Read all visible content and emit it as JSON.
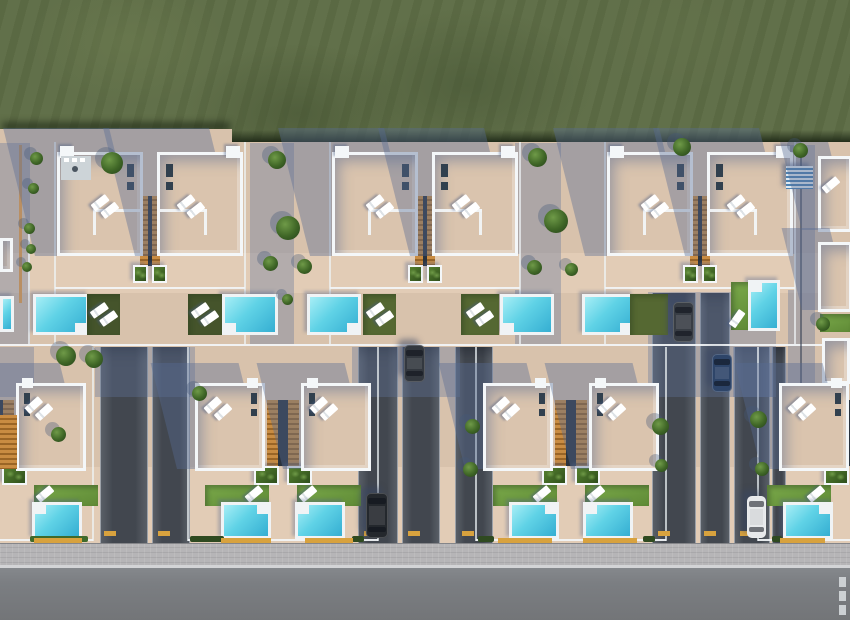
{
  "meta": {
    "description": "Aerial top-down 3D architectural render of a villa development: green field above, two rows of white semi-detached villas with beige roof terraces, sun loungers, orange stair cores, green planters, lawns and turquoise pools, dark private driveways with parked cars, a cobbled sidewalk and an asphalt road along the bottom.",
    "width": 850,
    "height": 620
  },
  "palette": {
    "grass": "#5e6d46",
    "grass_light": "#6d7c52",
    "grass_dark": "#4a593a",
    "grass_shadow": "#222e1c",
    "ground": "#d8c2ac",
    "ground_lit": "#e2ccb6",
    "wall": "#f4f7f9",
    "roof": "#dac4ae",
    "roof_inner_shadow": "rgba(85,105,145,0.5)",
    "cast_shadow": "rgba(88,108,148,0.40)",
    "ambient_shadow": "rgba(96,117,156,0.36)",
    "drive_mid": "#42474f",
    "drive_edge": "#5d636b",
    "deck": "#f0f3f5",
    "water_light": "#a7eef6",
    "water_mid": "#5fd2e6",
    "water_deep": "#35aed2",
    "lawn_bright_1": "#7aa94a",
    "lawn_bright_2": "#5f8a36",
    "lawn_mid": "#556832",
    "lawn_dark": "#45542b",
    "stair": "#c98c42",
    "stair_dark": "#9a6526",
    "stair_slit": "#2b333d",
    "planter_1": "#55802f",
    "planter_2": "#2f4f1c",
    "tree_light": "#6f9a48",
    "tree_mid": "#3f6626",
    "tree_dark": "#24401a",
    "sidewalk": "#b6b5b7",
    "curb": "#d3d4d6",
    "road": "#7b7e82",
    "road_dash": "#ccd0d3",
    "curb_yellow": "#d8a23e",
    "slot_dark": "#31404e",
    "pergola_blue": "#4d82b2",
    "pergola_white": "#dfe9f1",
    "kitchen": "#cdd4d8",
    "kitchen_dark": "#4a5560",
    "fence_tan": "#b98f63",
    "car_glass": "rgba(12,17,26,0.55)"
  },
  "bands": {
    "grass_h": 142,
    "step_w": 232,
    "lit_bands": [
      [
        0,
        253,
        850,
        40
      ],
      [
        0,
        467,
        850,
        76
      ]
    ],
    "fence_y": 344,
    "sidewalk_y": 543,
    "road_y": 568
  },
  "row1_pairs": [
    {
      "cx": 150,
      "kitchen": true,
      "pools": [
        {
          "x": 33,
          "y": 294,
          "w": 56,
          "h": 41,
          "step": "br"
        },
        {
          "x": 222,
          "y": 294,
          "w": 56,
          "h": 41,
          "step": "bl"
        }
      ],
      "lawns": [
        {
          "x": 87,
          "y": 294,
          "w": 33,
          "h": 41,
          "shade": "dark",
          "loungers": "pair",
          "lrot": -35
        },
        {
          "x": 188,
          "y": 294,
          "w": 34,
          "h": 41,
          "shade": "dark",
          "loungers": "pair",
          "lrot": -35
        }
      ]
    },
    {
      "cx": 425,
      "pools": [
        {
          "x": 307,
          "y": 294,
          "w": 54,
          "h": 41,
          "step": "br"
        },
        {
          "x": 500,
          "y": 294,
          "w": 54,
          "h": 41,
          "step": "bl"
        }
      ],
      "lawns": [
        {
          "x": 363,
          "y": 294,
          "w": 33,
          "h": 41,
          "shade": "mid",
          "loungers": "pair",
          "lrot": -35
        },
        {
          "x": 461,
          "y": 294,
          "w": 38,
          "h": 41,
          "shade": "mid",
          "loungers": "pair",
          "lrot": -35
        }
      ]
    },
    {
      "cx": 700,
      "pools": [
        {
          "x": 582,
          "y": 294,
          "w": 52,
          "h": 41,
          "step": "br"
        },
        {
          "x": 748,
          "y": 280,
          "w": 32,
          "h": 51,
          "step": "tl"
        }
      ],
      "lawns": [
        {
          "x": 630,
          "y": 294,
          "w": 38,
          "h": 41,
          "shade": "mid"
        },
        {
          "x": 731,
          "y": 282,
          "w": 17,
          "h": 48,
          "shade": "bright",
          "loungers": "single",
          "lrot": -55,
          "lx": 733,
          "ly": 310
        }
      ]
    }
  ],
  "row2_pairs": [
    {
      "cx": -2,
      "sides": "right",
      "pool_shift": 22
    },
    {
      "cx": 283,
      "sides": "both"
    },
    {
      "cx": 571,
      "sides": "both"
    },
    {
      "cx": 853,
      "sides": "left",
      "pool_shift": -8,
      "house_shift": 14
    }
  ],
  "driveways": [
    {
      "x": 100,
      "w": 48
    },
    {
      "x": 152,
      "w": 38
    },
    {
      "x": 358,
      "w": 40
    },
    {
      "x": 402,
      "w": 38
    },
    {
      "x": 455,
      "w": 38
    },
    {
      "x": 652,
      "w": 44,
      "y0": 293
    },
    {
      "x": 700,
      "w": 30,
      "y0": 293
    },
    {
      "x": 734,
      "w": 36
    },
    {
      "x": 772,
      "w": 14
    }
  ],
  "corridor_shadows": [
    [
      250,
      143,
      44,
      201
    ],
    [
      515,
      143,
      46,
      201
    ],
    [
      788,
      145,
      27,
      255
    ],
    [
      0,
      143,
      30,
      201
    ],
    [
      95,
      347,
      100,
      50
    ],
    [
      352,
      347,
      108,
      50
    ],
    [
      648,
      292,
      128,
      105
    ],
    [
      0,
      347,
      34,
      50
    ],
    [
      733,
      347,
      40,
      50
    ]
  ],
  "trees": [
    [
      112,
      163,
      22
    ],
    [
      36,
      158,
      13
    ],
    [
      33,
      188,
      11
    ],
    [
      29,
      228,
      11
    ],
    [
      31,
      249,
      10
    ],
    [
      27,
      267,
      10
    ],
    [
      277,
      160,
      18
    ],
    [
      288,
      228,
      24
    ],
    [
      270,
      263,
      15
    ],
    [
      304,
      266,
      15
    ],
    [
      537,
      157,
      19
    ],
    [
      556,
      221,
      24
    ],
    [
      534,
      267,
      15
    ],
    [
      571,
      269,
      13
    ],
    [
      682,
      147,
      18
    ],
    [
      800,
      150,
      15
    ],
    [
      823,
      324,
      14
    ],
    [
      66,
      356,
      20
    ],
    [
      94,
      359,
      18
    ],
    [
      58,
      434,
      15
    ],
    [
      199,
      393,
      15
    ],
    [
      472,
      426,
      15
    ],
    [
      470,
      469,
      15
    ],
    [
      660,
      426,
      17
    ],
    [
      661,
      465,
      13
    ],
    [
      758,
      419,
      17
    ],
    [
      762,
      469,
      14
    ],
    [
      287,
      299,
      11
    ]
  ],
  "cars": [
    {
      "x": 404,
      "y": 345,
      "w": 21,
      "h": 37,
      "color": "#33383f"
    },
    {
      "x": 673,
      "y": 302,
      "w": 21,
      "h": 40,
      "color": "#383d44"
    },
    {
      "x": 712,
      "y": 354,
      "w": 20,
      "h": 38,
      "color": "#2e4569"
    },
    {
      "x": 366,
      "y": 493,
      "w": 22,
      "h": 45,
      "color": "#24282d"
    },
    {
      "x": 747,
      "y": 496,
      "w": 19,
      "h": 42,
      "color": "#e7e9eb",
      "light": true
    }
  ],
  "yellow_curbs": {
    "y": 538,
    "h": 5,
    "pool_fronts": [
      [
        34,
        48
      ],
      [
        221,
        50
      ],
      [
        305,
        48
      ],
      [
        498,
        54
      ],
      [
        583,
        54
      ],
      [
        780,
        45
      ]
    ],
    "drive_mouths": [
      [
        104,
        12
      ],
      [
        158,
        12
      ],
      [
        364,
        12
      ],
      [
        408,
        12
      ],
      [
        462,
        12
      ],
      [
        658,
        12
      ],
      [
        704,
        12
      ],
      [
        740,
        12
      ]
    ]
  },
  "hedges": [
    [
      190,
      34,
      "#2f4a20"
    ],
    [
      352,
      12,
      "#2f4a20"
    ],
    [
      478,
      16,
      "#2f4a20"
    ],
    [
      643,
      12,
      "#2f4a20"
    ],
    [
      30,
      58,
      "#3f6a2b"
    ],
    [
      772,
      10,
      "#2f4a20"
    ]
  ],
  "road_dashes": {
    "x": 839,
    "w": 7,
    "h": 10,
    "ys_rel": [
      9,
      23,
      37
    ]
  },
  "pergola": {
    "x": 786,
    "y": 166,
    "w": 27,
    "h": 23
  },
  "right_column": {
    "fence_x": 800,
    "houses": [
      {
        "x": 818,
        "y": 156,
        "w": 34,
        "h": 76
      },
      {
        "x": 818,
        "y": 242,
        "w": 34,
        "h": 70
      }
    ],
    "lawn": {
      "x": 820,
      "y": 314,
      "w": 30,
      "h": 18
    },
    "block": {
      "x": 822,
      "y": 338,
      "w": 28,
      "h": 46
    }
  },
  "left_edge": {
    "pool": {
      "x": 0,
      "y": 296,
      "w": 14,
      "h": 36
    },
    "wall": {
      "x": 0,
      "y": 238,
      "w": 13,
      "h": 34
    },
    "fence_x": 19,
    "stairs": {
      "x": 0,
      "y": 415,
      "w": 17,
      "h": 54
    },
    "extra_wall_line": {
      "x": 28,
      "y": 230,
      "w": 2,
      "h": 114
    }
  }
}
